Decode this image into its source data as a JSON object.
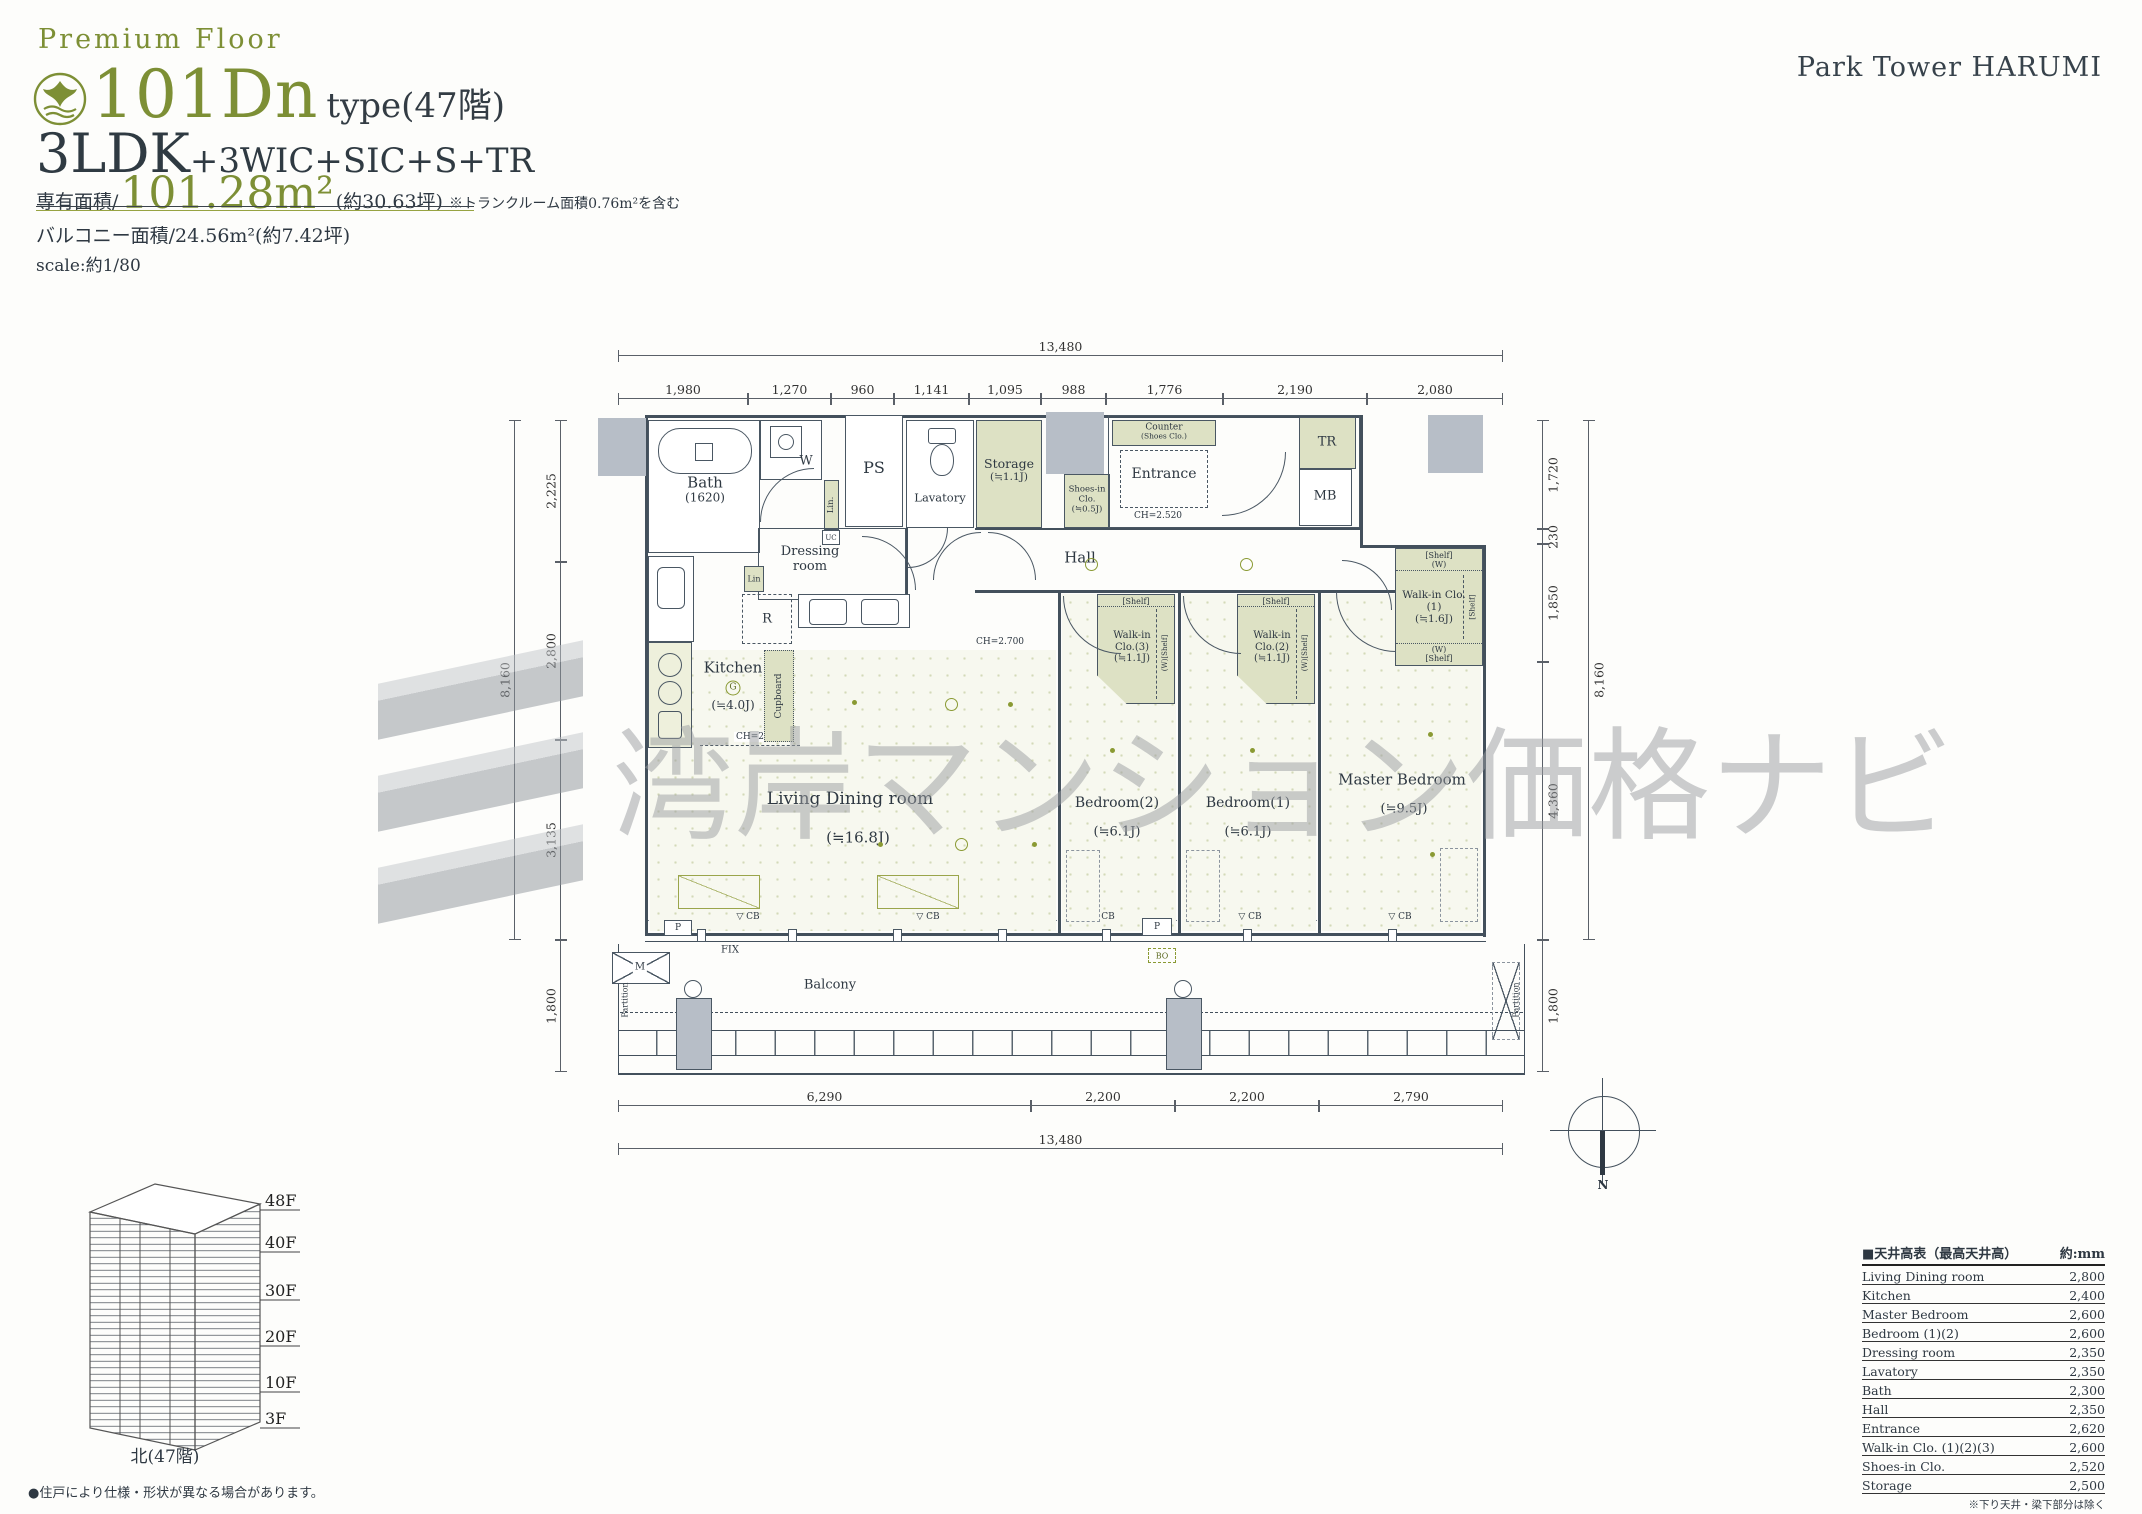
{
  "header": {
    "premium_floor": "Premium Floor",
    "type_code": "101Dn",
    "type_suffix": "type(47階)",
    "layout_main": "3LDK",
    "layout_plus": "+3WIC+SIC+S+TR",
    "area_label": "専有面積/",
    "area_value": "101.28m²",
    "area_tsubo": "(約30.63坪)",
    "area_note": "※トランクルーム面積0.76m²を含む",
    "balcony_area": "バルコニー面積/24.56m²(約7.42坪)",
    "scale": "scale:約1/80"
  },
  "brand": "Park Tower HARUMI",
  "watermark": "湾岸マンション価格ナビ",
  "dimensions": {
    "top_total": "13,480",
    "top": [
      "1,980",
      "1,270",
      "960",
      "1,141",
      "1,095",
      "988",
      "1,776",
      "2,190",
      "2,080"
    ],
    "bottom": [
      "6,290",
      "2,200",
      "2,200",
      "2,790"
    ],
    "bottom_total": "13,480",
    "left": [
      "2,225",
      "2,800",
      "3,135"
    ],
    "left_total": "8,160",
    "left_balcony": "1,800",
    "right": [
      "1,720",
      "230",
      "1,850",
      "4,360"
    ],
    "right_total": "8,160",
    "right_balcony": "1,800"
  },
  "rooms": {
    "bath": {
      "name": "Bath",
      "size": "(1620)"
    },
    "washer": "W",
    "ps": "PS",
    "lavatory": "Lavatory",
    "storage": {
      "name": "Storage",
      "size": "(≒1.1J)"
    },
    "shoes_in": {
      "name": "Shoes-in",
      "name2": "Clo.",
      "size": "(≒0.5J)"
    },
    "counter": {
      "name": "Counter",
      "sub": "(Shoes Clo.)"
    },
    "entrance": {
      "name": "Entrance",
      "ch": "CH=2.520"
    },
    "tr": "TR",
    "mb": "MB",
    "dressing": {
      "name": "Dressing",
      "name2": "room"
    },
    "lin1": "Lin.",
    "lin2": "Lin",
    "r": "R",
    "uc": "UC",
    "hall": {
      "name": "Hall",
      "ch": "CH=2.700"
    },
    "wic1": {
      "name": "Walk-in Clo.",
      "num": "(1)",
      "size": "(≒1.6J)",
      "shelf": "[Shelf]",
      "w": "(W)"
    },
    "wic2": {
      "name": "Walk-in",
      "num": "Clo.(2)",
      "size": "(≒1.1J)",
      "shelf": "[Shelf]",
      "side": "(W)[Shelf]"
    },
    "wic3": {
      "name": "Walk-in",
      "num": "Clo.(3)",
      "size": "(≒1.1J)",
      "shelf": "[Shelf]",
      "side": "(W)[Shelf]"
    },
    "kitchen": {
      "name": "Kitchen",
      "g": "G",
      "size": "(≒4.0J)",
      "ch": "CH=2.400"
    },
    "cupboard": "Cupboard",
    "ldk": {
      "name": "Living Dining room",
      "size": "(≒16.8J)"
    },
    "bedroom2": {
      "name": "Bedroom(2)",
      "size": "(≒6.1J)"
    },
    "bedroom1": {
      "name": "Bedroom(1)",
      "size": "(≒6.1J)"
    },
    "master": {
      "name": "Master Bedroom",
      "size": "(≒9.5J)"
    },
    "balcony": "Balcony",
    "fix": "FIX",
    "m": "M",
    "p": "P",
    "bo": "BO",
    "cb": "CB",
    "cb_mark": "▽",
    "partition": "Partition"
  },
  "compass": {
    "n": "N"
  },
  "building": {
    "floors": [
      "48F",
      "40F",
      "30F",
      "20F",
      "10F",
      "3F"
    ],
    "caption": "北(47階)",
    "note": "●住戸により仕様・形状が異なる場合があります。"
  },
  "ceiling_table": {
    "title": "■天井高表（最高天井高）",
    "unit": "約:mm",
    "rows": [
      {
        "label": "Living Dining room",
        "value": "2,800"
      },
      {
        "label": "Kitchen",
        "value": "2,400"
      },
      {
        "label": "Master Bedroom",
        "value": "2,600"
      },
      {
        "label": "Bedroom (1)(2)",
        "value": "2,600"
      },
      {
        "label": "Dressing room",
        "value": "2,350"
      },
      {
        "label": "Lavatory",
        "value": "2,350"
      },
      {
        "label": "Bath",
        "value": "2,300"
      },
      {
        "label": "Hall",
        "value": "2,350"
      },
      {
        "label": "Entrance",
        "value": "2,620"
      },
      {
        "label": "Walk-in Clo. (1)(2)(3)",
        "value": "2,600"
      },
      {
        "label": "Shoes-in Clo.",
        "value": "2,520"
      },
      {
        "label": "Storage",
        "value": "2,500"
      }
    ],
    "footnote": "※下り天井・梁下部分は除く"
  }
}
